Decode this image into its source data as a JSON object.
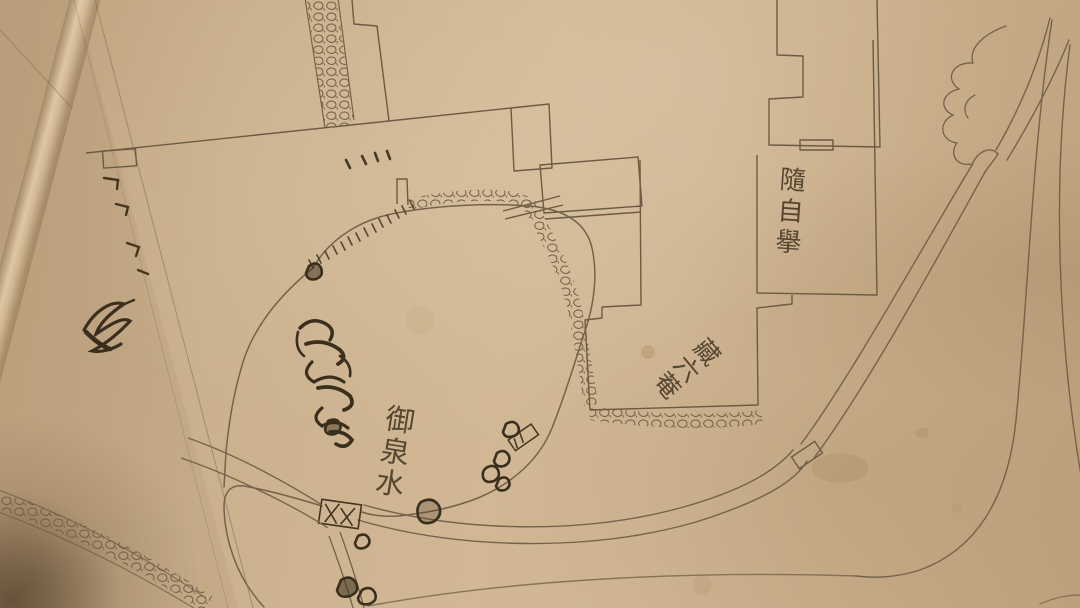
{
  "photo": {
    "subject": "hand-drawn Japanese garden map on aged creased paper",
    "labels": {
      "pond": {
        "text": "御泉水",
        "orientation": "vertical"
      },
      "hermitage": {
        "text": "藏六菴",
        "orientation": "diagonal"
      },
      "upper_building": {
        "text": "隨自擧",
        "orientation": "vertical"
      }
    },
    "features": [
      {
        "name": "pond-outline"
      },
      {
        "name": "rock-island-ink-drawing"
      },
      {
        "name": "plank-bridge-x-hatched"
      },
      {
        "name": "small-bridge"
      },
      {
        "name": "stepping-stones"
      },
      {
        "name": "shoreline-hatching"
      },
      {
        "name": "cobblestone-path-top"
      },
      {
        "name": "cobblestone-path-bottom-left"
      },
      {
        "name": "cobblestone-edging-hermitage"
      },
      {
        "name": "garden-road-double-line"
      },
      {
        "name": "road-waypoint-marker"
      },
      {
        "name": "tree-foliage-scallops"
      },
      {
        "name": "building-outlines"
      },
      {
        "name": "gate-rectangle"
      },
      {
        "name": "dot-tick-marks"
      },
      {
        "name": "paper-fold-crease"
      },
      {
        "name": "cursive-brush-mark"
      },
      {
        "name": "paper-stains"
      }
    ],
    "colors": {
      "paper": "#c9ae8c",
      "paper_light": "#d8c2a2",
      "ink": "#433620",
      "pencil": "#70604a",
      "fold_highlight": "#e8d4ae",
      "corner_shadow": "#231608"
    }
  }
}
